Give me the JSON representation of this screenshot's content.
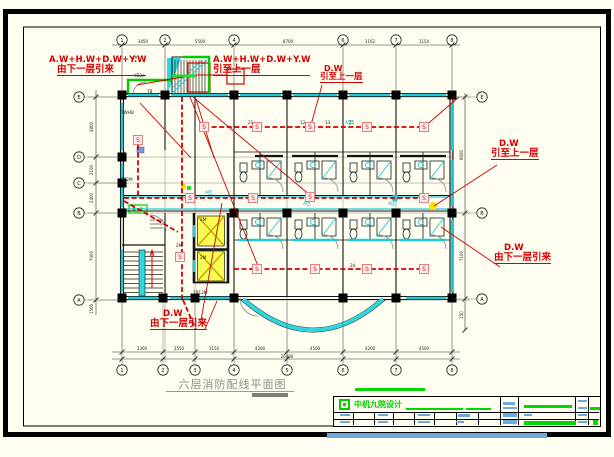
{
  "drawing_title": {
    "text": "六层消防配线平面图"
  },
  "annotations": {
    "a1": {
      "l1": "A.W+H.W+D.W+Y.W",
      "l2": "由下一层引来"
    },
    "a2": {
      "l1": "A.W+H.W+D.W+Y.W",
      "l2": "引至上一层"
    },
    "a3": {
      "l1": "D.W",
      "l2": "引至上一层"
    },
    "a4": {
      "l1": "D.W",
      "l2": "引至上一层"
    },
    "a5": {
      "l1": "D.W",
      "l2": "由下一层引来"
    },
    "a6": {
      "l1": "D.W",
      "l2": "由下一层引来"
    }
  },
  "titleblock": {
    "company": "中机九院设计"
  },
  "colors": {
    "cream": "#FFFEF0",
    "wall": "#141414",
    "grid": "#555555",
    "dim": "#333333",
    "cyan": "#1FCBD5",
    "wire": "#CE0000",
    "red": "#D40000",
    "green": "#00CC00",
    "lime": "#22DD22",
    "yellow": "#FFFB55",
    "yellow_line": "#BCA800",
    "pink_fill": "#FFECEC",
    "pink_edge": "#E08080",
    "s_text": "#CC2222",
    "door": "#949494",
    "blue_bar": "#6FA8DC",
    "green_bar": "#00D800"
  },
  "grid": {
    "top": {
      "y": 40,
      "items": [
        {
          "x": 122,
          "label": "1"
        },
        {
          "x": 165,
          "label": "2"
        },
        {
          "x": 234,
          "label": "4"
        },
        {
          "x": 343,
          "label": "6"
        },
        {
          "x": 396,
          "label": "7"
        },
        {
          "x": 452,
          "label": "8"
        }
      ]
    },
    "bottom": {
      "y": 370,
      "items": [
        {
          "x": 122,
          "label": "1"
        },
        {
          "x": 163,
          "label": "2"
        },
        {
          "x": 195,
          "label": "3"
        },
        {
          "x": 234,
          "label": "4"
        },
        {
          "x": 287,
          "label": "5"
        },
        {
          "x": 343,
          "label": "6"
        },
        {
          "x": 396,
          "label": "7"
        },
        {
          "x": 452,
          "label": "8"
        }
      ]
    },
    "left": {
      "x": 79,
      "items": [
        {
          "y": 97,
          "label": "E"
        },
        {
          "y": 157,
          "label": "D"
        },
        {
          "y": 183,
          "label": "C"
        },
        {
          "y": 213,
          "label": "B"
        },
        {
          "y": 300,
          "label": "A"
        }
      ]
    },
    "right": {
      "x": 482,
      "items": [
        {
          "y": 97,
          "label": "E"
        },
        {
          "y": 213,
          "label": "B"
        },
        {
          "y": 299,
          "label": "A"
        }
      ]
    }
  },
  "dims": {
    "top": {
      "y": 43,
      "items": [
        {
          "x": 143,
          "text": "3450"
        },
        {
          "x": 200,
          "text": "5500"
        },
        {
          "x": 288,
          "text": "8700"
        },
        {
          "x": 370,
          "text": "3162"
        },
        {
          "x": 424,
          "text": "3154"
        }
      ]
    },
    "bottom": {
      "y": 350,
      "items": [
        {
          "x": 142,
          "text": "3300"
        },
        {
          "x": 179,
          "text": "2550"
        },
        {
          "x": 214,
          "text": "3150"
        },
        {
          "x": 260,
          "text": "4200"
        },
        {
          "x": 315,
          "text": "4500"
        },
        {
          "x": 370,
          "text": "4200"
        },
        {
          "x": 424,
          "text": "4500"
        }
      ]
    },
    "bottom_total": {
      "x": 287,
      "y": 358,
      "text": "26400"
    },
    "left": {
      "x": 93,
      "items": [
        {
          "y": 127,
          "text": "4800"
        },
        {
          "y": 170,
          "text": "2100"
        },
        {
          "y": 198,
          "text": "2400"
        },
        {
          "y": 256,
          "text": "7000"
        },
        {
          "y": 309,
          "text": "1500"
        }
      ]
    },
    "right": {
      "x": 463,
      "items": [
        {
          "y": 155,
          "text": "9600"
        },
        {
          "y": 256,
          "text": "7100"
        },
        {
          "y": 315,
          "text": "150"
        }
      ]
    }
  },
  "plan": {
    "detector_label": "S",
    "detectors": [
      [
        204,
        127
      ],
      [
        257,
        127
      ],
      [
        310,
        127
      ],
      [
        367,
        127
      ],
      [
        424,
        127
      ],
      [
        138,
        140
      ],
      [
        190,
        198
      ],
      [
        253,
        198
      ],
      [
        310,
        197
      ],
      [
        424,
        198
      ],
      [
        180,
        257
      ],
      [
        257,
        269
      ],
      [
        315,
        269
      ],
      [
        367,
        269
      ],
      [
        424,
        269
      ]
    ],
    "columns": [
      [
        122,
        95
      ],
      [
        165,
        95
      ],
      [
        234,
        95
      ],
      [
        287,
        95
      ],
      [
        343,
        95
      ],
      [
        396,
        95
      ],
      [
        452,
        95
      ],
      [
        122,
        157
      ],
      [
        122,
        183
      ],
      [
        122,
        213
      ],
      [
        234,
        213
      ],
      [
        287,
        213
      ],
      [
        343,
        213
      ],
      [
        396,
        213
      ],
      [
        452,
        213
      ],
      [
        122,
        298
      ],
      [
        163,
        298
      ],
      [
        195,
        298
      ],
      [
        234,
        298
      ],
      [
        343,
        298
      ],
      [
        396,
        298
      ],
      [
        452,
        298
      ]
    ],
    "windows": [
      [
        128,
        95,
        159,
        95
      ],
      [
        171,
        95,
        228,
        95
      ],
      [
        240,
        95,
        281,
        95
      ],
      [
        293,
        95,
        337,
        95
      ],
      [
        349,
        95,
        390,
        95
      ],
      [
        402,
        95,
        446,
        95
      ],
      [
        122,
        103,
        122,
        150
      ],
      [
        122,
        163,
        122,
        178
      ],
      [
        122,
        188,
        122,
        207
      ],
      [
        122,
        250,
        122,
        292
      ],
      [
        452,
        103,
        452,
        150
      ],
      [
        452,
        160,
        452,
        206
      ],
      [
        452,
        220,
        452,
        292
      ],
      [
        128,
        298,
        158,
        298
      ],
      [
        170,
        298,
        190,
        298
      ],
      [
        200,
        298,
        229,
        298
      ],
      [
        406,
        298,
        446,
        298
      ],
      [
        238,
        240,
        283,
        240
      ],
      [
        292,
        240,
        338,
        240
      ],
      [
        347,
        240,
        393,
        240
      ],
      [
        400,
        240,
        446,
        240
      ]
    ],
    "wiring_runs": [
      [
        [
          204,
          127
        ],
        [
          424,
          127
        ]
      ],
      [
        [
          124,
          198
        ],
        [
          424,
          198
        ]
      ],
      [
        [
          234,
          269
        ],
        [
          424,
          269
        ]
      ],
      [
        [
          182,
          97
        ],
        [
          182,
          300
        ]
      ],
      [
        [
          138,
          145
        ],
        [
          138,
          196
        ]
      ],
      [
        [
          124,
          201
        ],
        [
          178,
          232
        ]
      ],
      [
        [
          183,
          300
        ],
        [
          196,
          330
        ]
      ]
    ],
    "leaders": [
      [
        137,
        85,
        183,
        77
      ],
      [
        196,
        75,
        227,
        75
      ],
      [
        322,
        85,
        311,
        125
      ],
      [
        497,
        165,
        434,
        206
      ],
      [
        500,
        267,
        441,
        227
      ],
      [
        205,
        329,
        217,
        301
      ],
      [
        190,
        97,
        258,
        266
      ],
      [
        193,
        97,
        311,
        196
      ],
      [
        140,
        103,
        191,
        158
      ],
      [
        196,
        99,
        214,
        158
      ],
      [
        424,
        127,
        459,
        97
      ],
      [
        222,
        203,
        201,
        320
      ]
    ],
    "micro_labels": [
      {
        "t": "J#",
        "x": 133,
        "y": 59
      },
      {
        "t": "YB2a",
        "x": 134,
        "y": 77
      },
      {
        "t": "TB",
        "x": 147,
        "y": 93
      },
      {
        "t": "7WHB",
        "x": 121,
        "y": 114
      },
      {
        "t": "3E2M",
        "x": 121,
        "y": 181
      },
      {
        "t": "2M",
        "x": 176,
        "y": 247
      },
      {
        "t": "1B12M",
        "x": 193,
        "y": 294
      },
      {
        "t": "21",
        "x": 248,
        "y": 124
      },
      {
        "t": "12",
        "x": 300,
        "y": 124
      },
      {
        "t": "13",
        "x": 325,
        "y": 124
      },
      {
        "t": "21",
        "x": 349,
        "y": 124
      },
      {
        "t": "24",
        "x": 350,
        "y": 267
      },
      {
        "t": "2M",
        "x": 200,
        "y": 221
      },
      {
        "t": "2M",
        "x": 200,
        "y": 259
      }
    ],
    "cyan_labels": [
      {
        "t": "A区",
        "x": 205,
        "y": 194
      },
      {
        "t": "A区",
        "x": 303,
        "y": 205
      },
      {
        "t": "A区",
        "x": 388,
        "y": 205
      },
      {
        "t": "A区",
        "x": 345,
        "y": 124
      }
    ]
  }
}
